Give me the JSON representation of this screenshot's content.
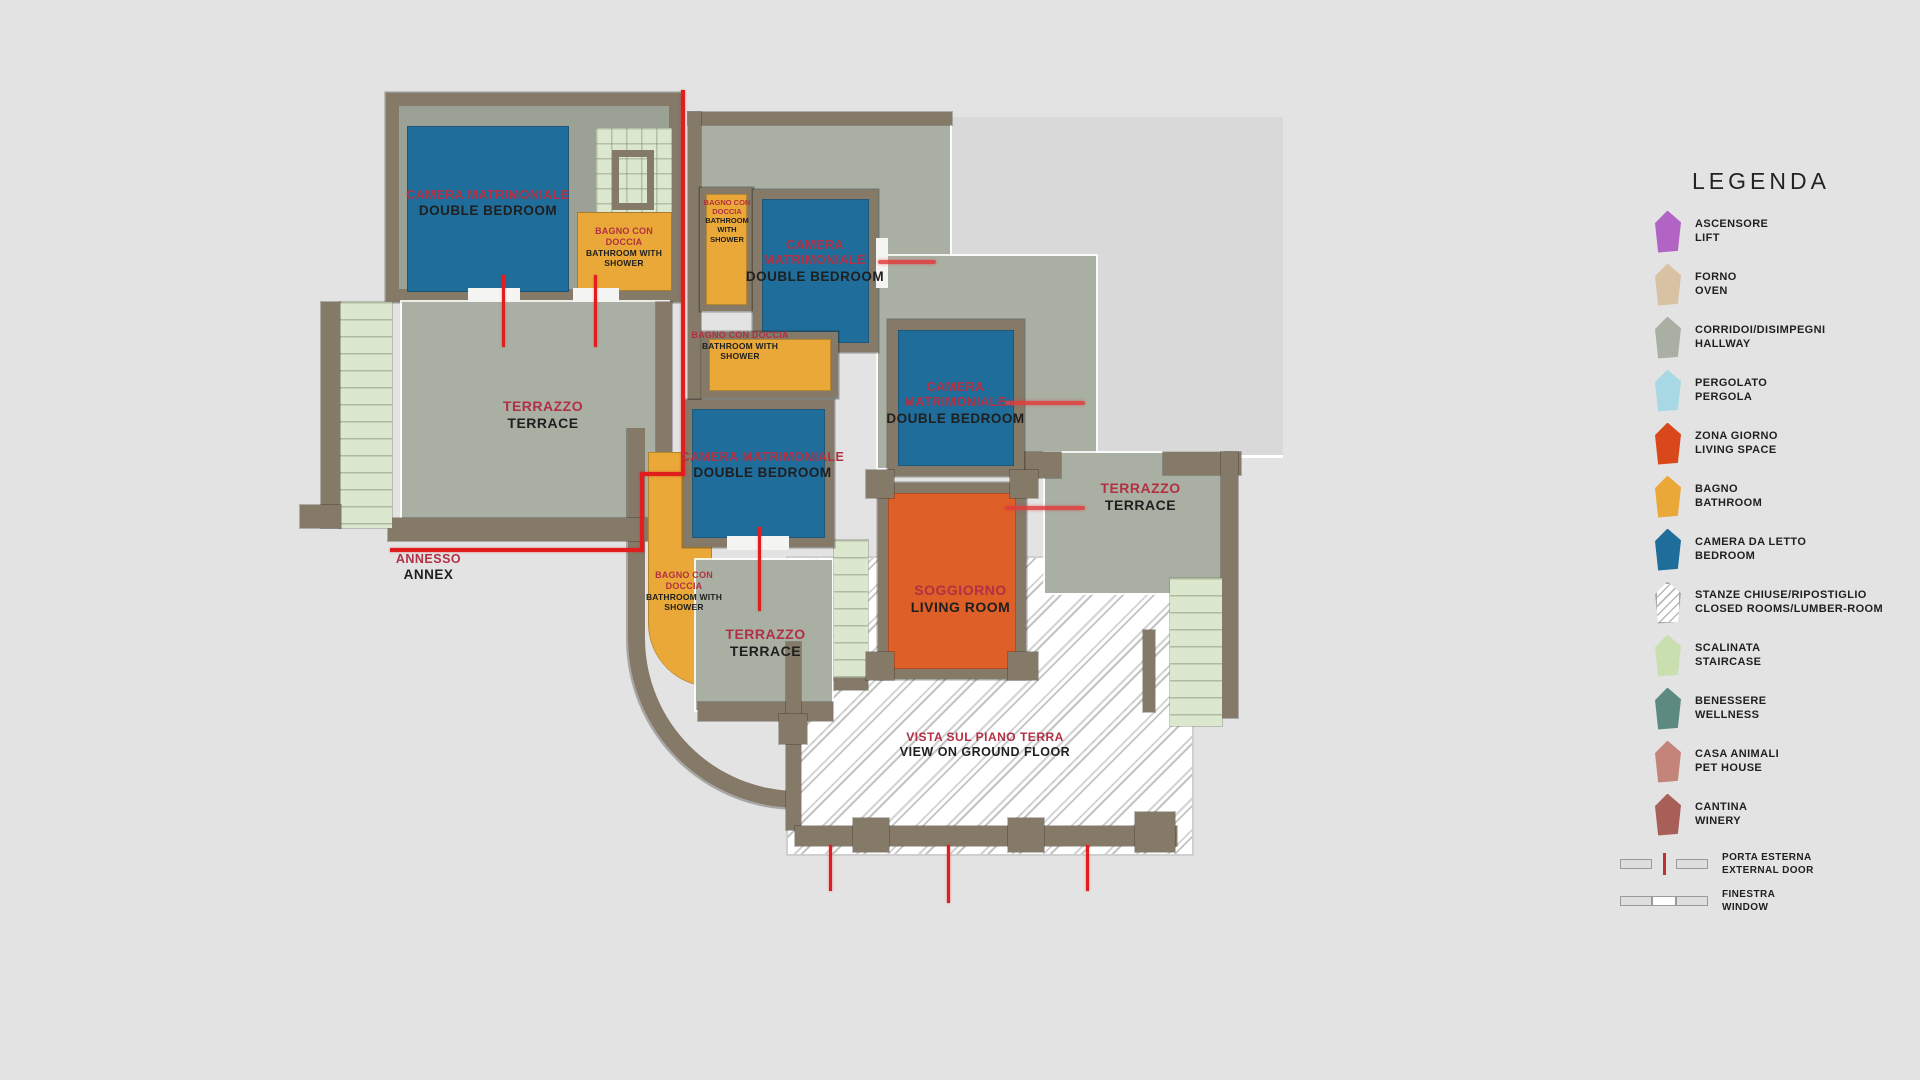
{
  "colors": {
    "background": "#e3e3e3",
    "roof": "#d9d9d9",
    "wall": "#857968",
    "hallway": "#a9b0a3",
    "stair": "#dce8cd",
    "bedroom": "#1f6d9b",
    "bathroom": "#e9a837",
    "living": "#df5f28",
    "crimson": "#b13043",
    "dark": "#1f1f1f",
    "red": "#e01e1e"
  },
  "plan": {
    "bedroom_annex": {
      "it": "CAMERA MATRIMONIALE",
      "en": "DOUBLE BEDROOM"
    },
    "bathroom_annex": {
      "it": "BAGNO CON DOCCIA",
      "en": "BATHROOM WITH SHOWER"
    },
    "terrace_annex": {
      "it": "TERRAZZO",
      "en": "TERRACE"
    },
    "annex": {
      "it": "ANNESSO",
      "en": "ANNEX"
    },
    "bathroom_top": {
      "it": "BAGNO CON DOCCIA",
      "en": "BATHROOM WITH SHOWER"
    },
    "bedroom_top": {
      "it": "CAMERA MATRIMONIALE",
      "en": "DOUBLE BEDROOM"
    },
    "bathroom_mid": {
      "it": "BAGNO CON DOCCIA",
      "en": "BATHROOM WITH SHOWER"
    },
    "bedroom_right": {
      "it": "CAMERA MATRIMONIALE",
      "en": "DOUBLE BEDROOM"
    },
    "bedroom_mid": {
      "it": "CAMERA MATRIMONIALE",
      "en": "DOUBLE BEDROOM"
    },
    "bathroom_curve": {
      "it": "BAGNO CON DOCCIA",
      "en": "BATHROOM WITH SHOWER"
    },
    "terrace_mid": {
      "it": "TERRAZZO",
      "en": "TERRACE"
    },
    "terrace_right": {
      "it": "TERRAZZO",
      "en": "TERRACE"
    },
    "living_room": {
      "it": "SOGGIORNO",
      "en": "LIVING ROOM"
    },
    "vista": {
      "it": "VISTA SUL PIANO TERRA",
      "en": "VIEW ON GROUND FLOOR"
    }
  },
  "legend": {
    "title": "LEGENDA",
    "items": [
      {
        "it": "ASCENSORE",
        "en": "LIFT",
        "color": "#b264c4"
      },
      {
        "it": "FORNO",
        "en": "OVEN",
        "color": "#d8c2a4"
      },
      {
        "it": "CORRIDOI/DISIMPEGNI",
        "en": "HALLWAY",
        "color": "#a9b0a3"
      },
      {
        "it": "PERGOLATO",
        "en": "PERGOLA",
        "color": "#a8d8e4"
      },
      {
        "it": "ZONA GIORNO",
        "en": "LIVING SPACE",
        "color": "#d9481b"
      },
      {
        "it": "BAGNO",
        "en": "BATHROOM",
        "color": "#e9a837"
      },
      {
        "it": "CAMERA DA LETTO",
        "en": "BEDROOM",
        "color": "#1f6d9b"
      },
      {
        "it": "STANZE CHIUSE/RIPOSTIGLIO",
        "en": "CLOSED ROOMS/LUMBER-ROOM",
        "color": "hatch"
      },
      {
        "it": "SCALINATA",
        "en": "STAIRCASE",
        "color": "#cadfb0"
      },
      {
        "it": "BENESSERE",
        "en": "WELLNESS",
        "color": "#5d8a80"
      },
      {
        "it": "CASA ANIMALI",
        "en": "PET HOUSE",
        "color": "#c5847a"
      },
      {
        "it": "CANTINA",
        "en": "WINERY",
        "color": "#a85f58"
      }
    ],
    "symbols": [
      {
        "it": "PORTA ESTERNA",
        "en": "EXTERNAL DOOR"
      },
      {
        "it": "FINESTRA",
        "en": "WINDOW"
      }
    ]
  }
}
